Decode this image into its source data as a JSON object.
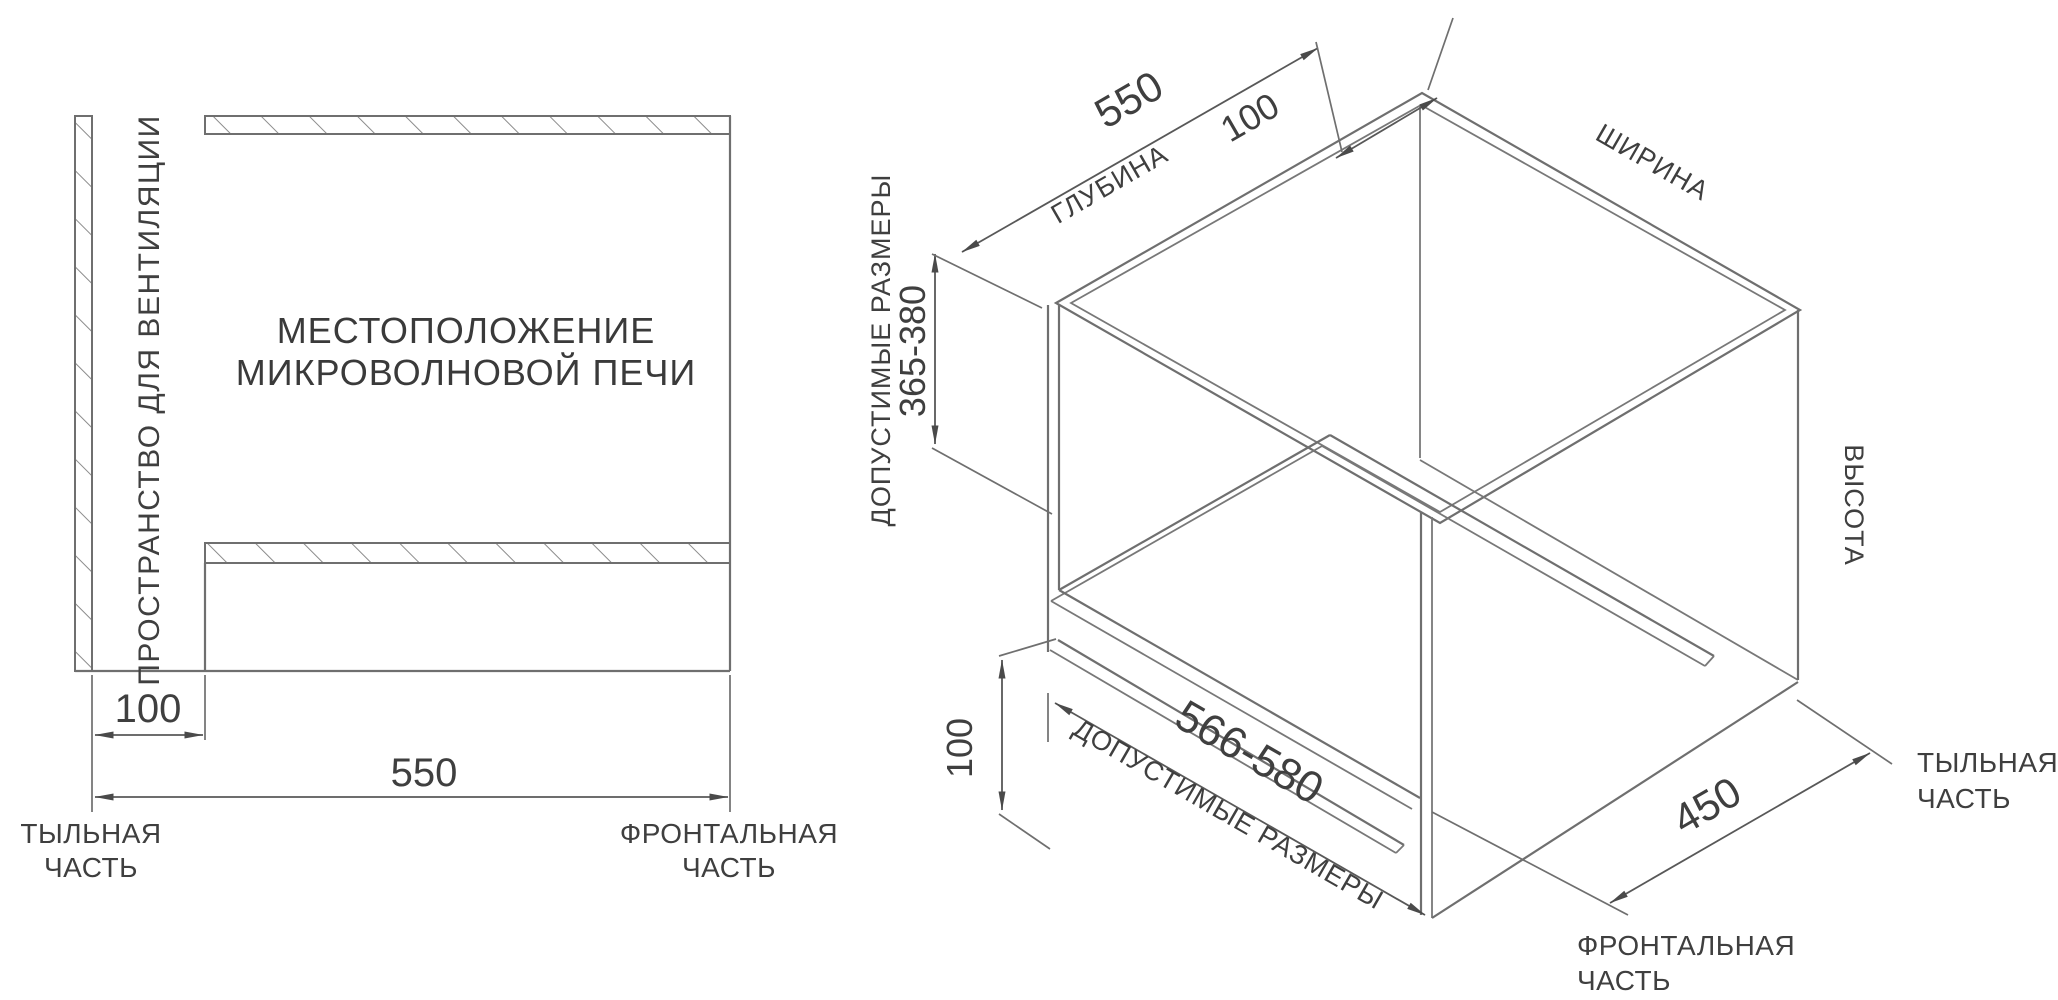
{
  "page": {
    "background": "#ffffff",
    "line_color": "#6f6f6f",
    "text_color": "#3f3f3f"
  },
  "left_diagram": {
    "title_line1": "МЕСТОПОЛОЖЕНИЕ",
    "title_line2": "МИКРОВОЛНОВОЙ ПЕЧИ",
    "ventilation_label": "ПРОСТРАНСТВО ДЛЯ ВЕНТИЛЯЦИИ",
    "dim_vent_gap": "100",
    "dim_depth": "550",
    "rear_label_line1": "ТЫЛЬНАЯ",
    "rear_label_line2": "ЧАСТЬ",
    "front_label_line1": "ФРОНТАЛЬНАЯ",
    "front_label_line2": "ЧАСТЬ"
  },
  "right_diagram": {
    "dim_depth": "550",
    "depth_label": "ГЛУБИНА",
    "dim_rear_gap": "100",
    "width_label": "ШИРИНА",
    "height_label": "ВЫСОТА",
    "allowed_sizes_label_vertical": "ДОПУСТИМЫЕ РАЗМЕРЫ",
    "dim_height_range": "365-380",
    "dim_bottom_gap": "100",
    "dim_width_range": "566-580",
    "allowed_sizes_label_bottom": "ДОПУСТИМЫЕ РАЗМЕРЫ",
    "dim_front": "450",
    "rear_label_line1": "ТЫЛЬНАЯ",
    "rear_label_line2": "ЧАСТЬ",
    "front_label_line1": "ФРОНТАЛЬНАЯ",
    "front_label_line2": "ЧАСТЬ"
  }
}
